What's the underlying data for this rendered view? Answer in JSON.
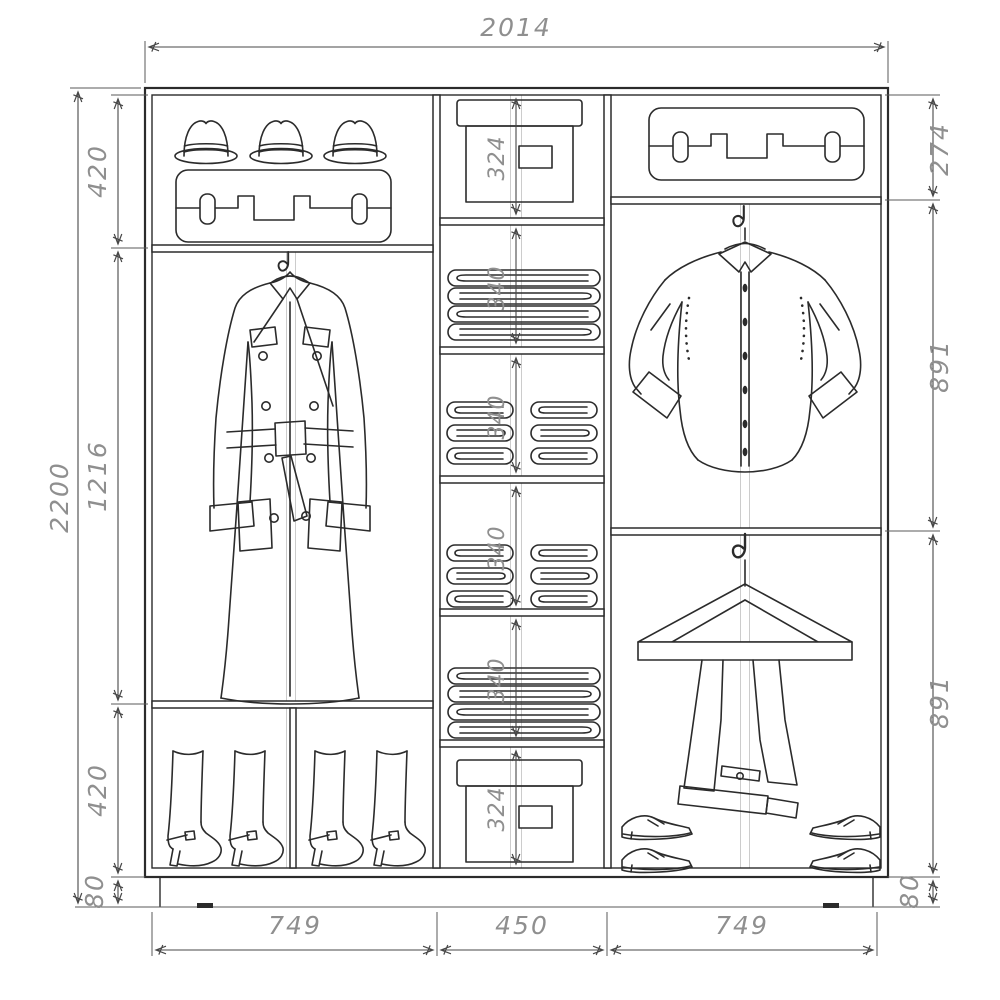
{
  "document": {
    "type": "furniture technical drawing",
    "subject": "Sliding wardrobe interior layout with clothes placement"
  },
  "colors": {
    "background": "#ffffff",
    "drawing_line": "#2b2b2b",
    "dimension_line": "#474747",
    "dimension_text": "#8f8f8f",
    "guide_line": "#cccccc"
  },
  "dimensions": {
    "total_width": "2014",
    "total_height": "2200",
    "left_column_width": "749",
    "center_column_width": "450",
    "right_column_width": "749",
    "left_top_section": "420",
    "left_middle_section": "1216",
    "left_bottom_section": "420",
    "left_plinth": "80",
    "right_top_section": "274",
    "right_upper_section": "891",
    "right_lower_section": "891",
    "right_plinth": "80",
    "center_shelf_heights": [
      "324",
      "340",
      "340",
      "340",
      "340",
      "324"
    ]
  },
  "contents": {
    "left_column": [
      "three fedora hats",
      "suitcase",
      "trench coat hanging on hook",
      "four high-heeled boots"
    ],
    "center_column": [
      "storage box",
      "folded clothes stack",
      "two folded clothes stacks",
      "two folded clothes stacks",
      "folded clothes stack",
      "storage box"
    ],
    "right_column": [
      "suitcase",
      "dress shirt hanging on hook",
      "trousers on wooden hanger",
      "four dress shoes"
    ]
  },
  "icons": {
    "hat": "fedora-hat-icon",
    "suitcase": "suitcase-icon",
    "coat": "trench-coat-icon",
    "folded_stack": "folded-clothes-icon",
    "box": "storage-box-icon",
    "boot": "high-heel-boot-icon",
    "shirt": "dress-shirt-icon",
    "trousers": "trousers-hanger-icon",
    "shoe": "dress-shoe-icon",
    "hook": "hook-icon"
  }
}
